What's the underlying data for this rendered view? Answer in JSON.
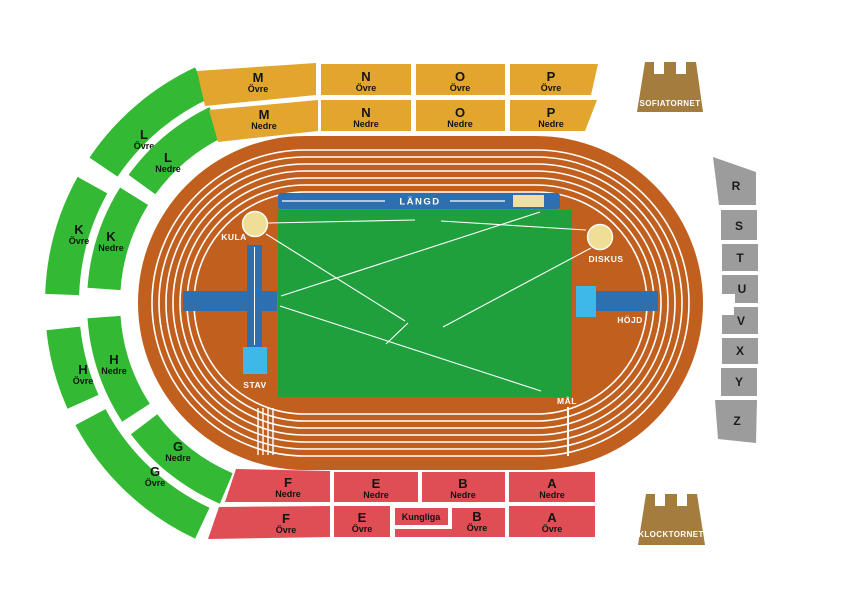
{
  "canvas": {
    "width": 867,
    "height": 592
  },
  "palette": {
    "background": "#ffffff",
    "track": "#C05F1E",
    "infield": "#1FA03C",
    "seat_green": "#33B933",
    "seat_yellow": "#E2A52D",
    "seat_red": "#DF4D55",
    "seat_gray": "#9C9C9C",
    "tower_brown": "#A37C3E",
    "runway_blue": "#2E6FB0",
    "mat_lightblue": "#3EB8E8",
    "sand": "#EFE0A0",
    "throw_circle": "#EFDE96",
    "line_white": "#ffffff",
    "label_black": "#141414"
  },
  "field": {
    "langd": "LÄNGD",
    "kula": "KULA",
    "diskus": "DISKUS",
    "hojd": "HÖJD",
    "stav": "STAV",
    "mal": "MÅL"
  },
  "towers": {
    "sofiatornet": {
      "label": "SOFIATORNET"
    },
    "klocktornet": {
      "label": "KLOCKTORNET"
    }
  },
  "track": {
    "lanes": 7,
    "outer": [
      138,
      136,
      565,
      334
    ],
    "corner_radius": 167,
    "lane_inset": 14,
    "lane_gap": 7
  },
  "infield_lines": [
    [
      268,
      223,
      415,
      220
    ],
    [
      441,
      221,
      586,
      230
    ],
    [
      266,
      234,
      405,
      321
    ],
    [
      408,
      323,
      386,
      344
    ],
    [
      281,
      296,
      540,
      212
    ],
    [
      280,
      306,
      541,
      391
    ],
    [
      443,
      327,
      591,
      248
    ]
  ],
  "sections": {
    "wedge_center": [
      305,
      303
    ],
    "wedges": [
      {
        "id": "l-ovre",
        "letter": "L",
        "tier": "Övre",
        "a0": 115,
        "a1": 146,
        "r0": 226,
        "r1": 260,
        "label": [
          144,
          139
        ]
      },
      {
        "id": "l-nedre",
        "letter": "L",
        "tier": "Nedre",
        "a0": 116,
        "a1": 144,
        "r0": 185,
        "r1": 218,
        "label": [
          168,
          162
        ]
      },
      {
        "id": "k-ovre",
        "letter": "K",
        "tier": "Övre",
        "a0": 151,
        "a1": 178,
        "r0": 226,
        "r1": 260,
        "label": [
          79,
          234
        ]
      },
      {
        "id": "k-nedre",
        "letter": "K",
        "tier": "Nedre",
        "a0": 148,
        "a1": 176,
        "r0": 185,
        "r1": 218,
        "label": [
          111,
          241
        ]
      },
      {
        "id": "h-ovre",
        "letter": "H",
        "tier": "Övre",
        "a0": 186,
        "a1": 204,
        "r0": 226,
        "r1": 260,
        "label": [
          83,
          374
        ]
      },
      {
        "id": "h-nedre",
        "letter": "H",
        "tier": "Nedre",
        "a0": 184,
        "a1": 213,
        "r0": 185,
        "r1": 218,
        "label": [
          114,
          364
        ]
      },
      {
        "id": "g-ovre",
        "letter": "G",
        "tier": "Övre",
        "a0": 208,
        "a1": 245,
        "r0": 226,
        "r1": 260,
        "label": [
          155,
          476
        ]
      },
      {
        "id": "g-nedre",
        "letter": "G",
        "tier": "Nedre",
        "a0": 217,
        "a1": 247,
        "r0": 185,
        "r1": 218,
        "label": [
          178,
          451
        ]
      }
    ],
    "stands": [
      {
        "id": "m-ovre",
        "letter": "M",
        "tier": "Övre",
        "color": "seat_yellow",
        "points": [
          [
            197,
            71
          ],
          [
            316,
            63
          ],
          [
            316,
            95
          ],
          [
            205,
            106
          ]
        ],
        "label": [
          258,
          82
        ]
      },
      {
        "id": "n-ovre",
        "letter": "N",
        "tier": "Övre",
        "color": "seat_yellow",
        "points": [
          [
            321,
            64
          ],
          [
            411,
            64
          ],
          [
            411,
            95
          ],
          [
            321,
            95
          ]
        ],
        "label": [
          366,
          81
        ]
      },
      {
        "id": "o-ovre",
        "letter": "O",
        "tier": "Övre",
        "color": "seat_yellow",
        "points": [
          [
            416,
            64
          ],
          [
            505,
            64
          ],
          [
            505,
            95
          ],
          [
            416,
            95
          ]
        ],
        "label": [
          460,
          81
        ]
      },
      {
        "id": "p-ovre",
        "letter": "P",
        "tier": "Övre",
        "color": "seat_yellow",
        "points": [
          [
            510,
            64
          ],
          [
            598,
            64
          ],
          [
            591,
            95
          ],
          [
            510,
            95
          ]
        ],
        "label": [
          551,
          81
        ]
      },
      {
        "id": "m-nedre",
        "letter": "M",
        "tier": "Nedre",
        "color": "seat_yellow",
        "points": [
          [
            209,
            110
          ],
          [
            318,
            100
          ],
          [
            318,
            131
          ],
          [
            218,
            142
          ]
        ],
        "label": [
          264,
          119
        ]
      },
      {
        "id": "n-nedre",
        "letter": "N",
        "tier": "Nedre",
        "color": "seat_yellow",
        "points": [
          [
            321,
            100
          ],
          [
            411,
            100
          ],
          [
            411,
            131
          ],
          [
            321,
            131
          ]
        ],
        "label": [
          366,
          117
        ]
      },
      {
        "id": "o-nedre",
        "letter": "O",
        "tier": "Nedre",
        "color": "seat_yellow",
        "points": [
          [
            416,
            100
          ],
          [
            505,
            100
          ],
          [
            505,
            131
          ],
          [
            416,
            131
          ]
        ],
        "label": [
          460,
          117
        ]
      },
      {
        "id": "p-nedre",
        "letter": "P",
        "tier": "Nedre",
        "color": "seat_yellow",
        "points": [
          [
            510,
            100
          ],
          [
            597,
            100
          ],
          [
            585,
            131
          ],
          [
            510,
            131
          ]
        ],
        "label": [
          551,
          117
        ]
      },
      {
        "id": "f-nedre",
        "letter": "F",
        "tier": "Nedre",
        "color": "seat_red",
        "points": [
          [
            236,
            469
          ],
          [
            330,
            471
          ],
          [
            330,
            502
          ],
          [
            225,
            502
          ]
        ],
        "label": [
          288,
          487
        ]
      },
      {
        "id": "e-nedre",
        "letter": "E",
        "tier": "Nedre",
        "color": "seat_red",
        "points": [
          [
            334,
            472
          ],
          [
            418,
            472
          ],
          [
            418,
            502
          ],
          [
            334,
            502
          ]
        ],
        "label": [
          376,
          488
        ]
      },
      {
        "id": "b-nedre",
        "letter": "B",
        "tier": "Nedre",
        "color": "seat_red",
        "points": [
          [
            422,
            472
          ],
          [
            505,
            472
          ],
          [
            505,
            502
          ],
          [
            422,
            502
          ]
        ],
        "label": [
          463,
          488
        ]
      },
      {
        "id": "a-nedre",
        "letter": "A",
        "tier": "Nedre",
        "color": "seat_red",
        "points": [
          [
            509,
            472
          ],
          [
            595,
            472
          ],
          [
            595,
            502
          ],
          [
            509,
            502
          ]
        ],
        "label": [
          552,
          488
        ]
      },
      {
        "id": "f-ovre",
        "letter": "F",
        "tier": "Övre",
        "color": "seat_red",
        "points": [
          [
            219,
            507
          ],
          [
            330,
            506
          ],
          [
            330,
            537
          ],
          [
            208,
            539
          ]
        ],
        "label": [
          286,
          523
        ]
      },
      {
        "id": "e-ovre",
        "letter": "E",
        "tier": "Övre",
        "color": "seat_red",
        "points": [
          [
            334,
            506
          ],
          [
            390,
            506
          ],
          [
            390,
            537
          ],
          [
            334,
            537
          ]
        ],
        "label": [
          362,
          522
        ]
      },
      {
        "id": "kungliga",
        "letter": "Kungliga",
        "tier": null,
        "small": true,
        "color": "seat_red",
        "points": [
          [
            395,
            508
          ],
          [
            448,
            508
          ],
          [
            448,
            525
          ],
          [
            395,
            525
          ]
        ],
        "label": [
          421,
          520
        ]
      },
      {
        "id": "b-ovre",
        "letter": "B",
        "tier": "Övre",
        "color": "seat_red",
        "points": [
          [
            452,
            508
          ],
          [
            505,
            508
          ],
          [
            505,
            537
          ],
          [
            395,
            537
          ],
          [
            395,
            529
          ],
          [
            452,
            529
          ]
        ],
        "label": [
          477,
          521
        ]
      },
      {
        "id": "a-ovre",
        "letter": "A",
        "tier": "Övre",
        "color": "seat_red",
        "points": [
          [
            509,
            506
          ],
          [
            595,
            506
          ],
          [
            595,
            537
          ],
          [
            509,
            537
          ]
        ],
        "label": [
          552,
          522
        ]
      },
      {
        "id": "r",
        "letter": "R",
        "tier": null,
        "color": "seat_gray",
        "points": [
          [
            713,
            157
          ],
          [
            756,
            172
          ],
          [
            756,
            205
          ],
          [
            719,
            205
          ]
        ],
        "label": [
          736,
          190
        ]
      },
      {
        "id": "s",
        "letter": "S",
        "tier": null,
        "color": "seat_gray",
        "points": [
          [
            721,
            210
          ],
          [
            757,
            210
          ],
          [
            757,
            240
          ],
          [
            721,
            240
          ]
        ],
        "label": [
          739,
          230
        ]
      },
      {
        "id": "t",
        "letter": "T",
        "tier": null,
        "color": "seat_gray",
        "points": [
          [
            722,
            244
          ],
          [
            758,
            244
          ],
          [
            758,
            271
          ],
          [
            722,
            271
          ]
        ],
        "label": [
          740,
          262
        ]
      },
      {
        "id": "u",
        "letter": "U",
        "tier": null,
        "color": "seat_gray",
        "points": [
          [
            722,
            275
          ],
          [
            758,
            275
          ],
          [
            758,
            303
          ],
          [
            735,
            303
          ],
          [
            735,
            294
          ],
          [
            722,
            294
          ]
        ],
        "label": [
          742,
          293
        ]
      },
      {
        "id": "v",
        "letter": "V",
        "tier": null,
        "color": "seat_gray",
        "points": [
          [
            734,
            307
          ],
          [
            758,
            307
          ],
          [
            758,
            334
          ],
          [
            722,
            334
          ],
          [
            722,
            315
          ],
          [
            734,
            315
          ]
        ],
        "label": [
          741,
          325
        ]
      },
      {
        "id": "x",
        "letter": "X",
        "tier": null,
        "color": "seat_gray",
        "points": [
          [
            722,
            338
          ],
          [
            758,
            338
          ],
          [
            758,
            364
          ],
          [
            722,
            364
          ]
        ],
        "label": [
          740,
          355
        ]
      },
      {
        "id": "y",
        "letter": "Y",
        "tier": null,
        "color": "seat_gray",
        "points": [
          [
            721,
            368
          ],
          [
            757,
            368
          ],
          [
            757,
            396
          ],
          [
            721,
            396
          ]
        ],
        "label": [
          739,
          386
        ]
      },
      {
        "id": "z",
        "letter": "Z",
        "tier": null,
        "color": "seat_gray",
        "points": [
          [
            715,
            400
          ],
          [
            757,
            400
          ],
          [
            756,
            443
          ],
          [
            718,
            439
          ]
        ],
        "label": [
          737,
          425
        ]
      }
    ]
  }
}
